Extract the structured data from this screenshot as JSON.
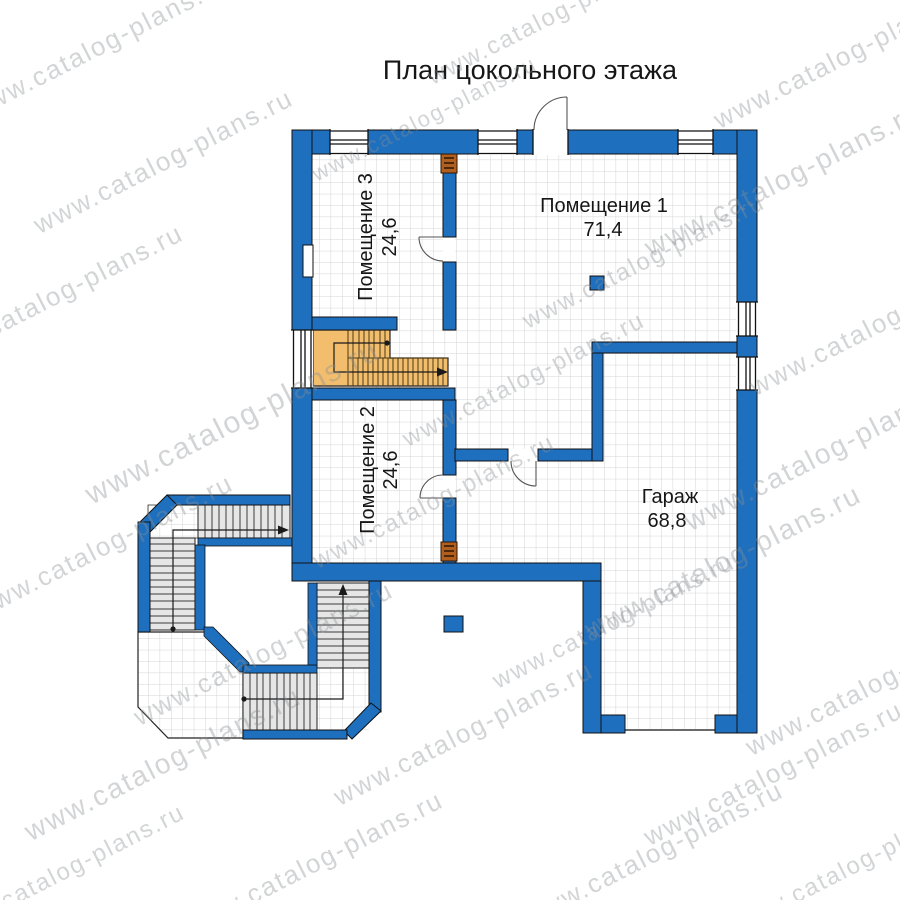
{
  "title": "План цокольного этажа",
  "watermark": {
    "text": "www.catalog-plans.ru"
  },
  "rooms": [
    {
      "name": "Помещение 1",
      "area": "71,4"
    },
    {
      "name": "Помещение 2",
      "area": "24,6"
    },
    {
      "name": "Помещение 3",
      "area": "24,6"
    },
    {
      "name": "Гараж",
      "area": "68,8"
    }
  ],
  "colors": {
    "wall_blue": "#1e6fbe",
    "stair_orange": "#f2bd6d",
    "tread_gray": "#e6e6e6",
    "tile_line": "#d6d6d6",
    "vent_brown": "#b15f1f",
    "watermark_gray": "#8b9094"
  }
}
